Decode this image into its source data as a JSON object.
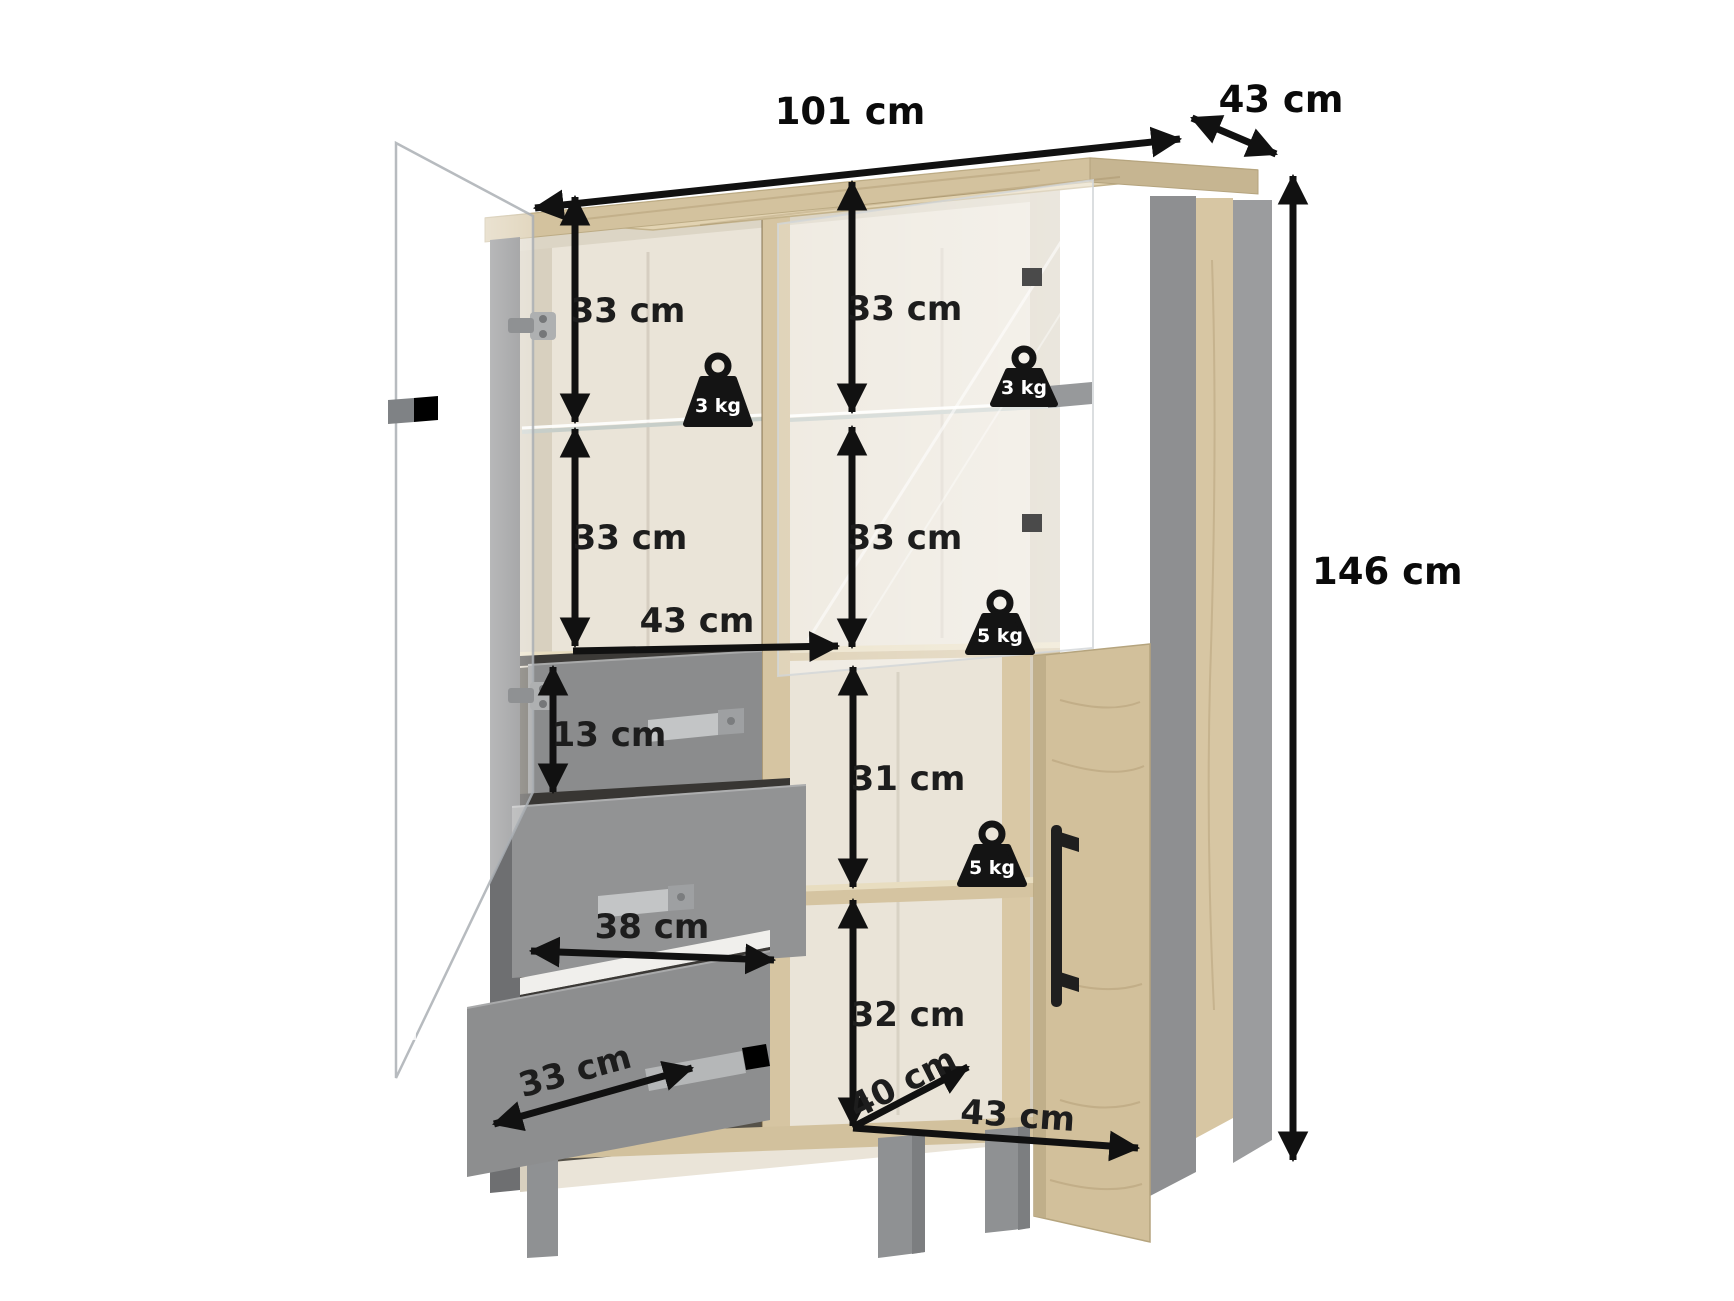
{
  "diagram": {
    "type": "furniture-dimension-diagram",
    "product": "display-cabinet",
    "background_color": "#ffffff",
    "annotation_color": "#111111",
    "overall": {
      "width": "101 cm",
      "depth": "43 cm",
      "height": "146 cm"
    },
    "internal": {
      "upper_left_height": "33 cm",
      "upper_right_height": "33 cm",
      "middle_left_height": "33 cm",
      "middle_right_height": "33 cm",
      "left_inner_width": "43 cm",
      "top_drawer_height": "13 cm",
      "drawer_width": "38 cm",
      "bottom_drawer_depth": "33 cm",
      "lower_right_upper_height": "31 cm",
      "lower_right_lower_height": "32 cm",
      "inner_depth": "40 cm",
      "lower_right_width": "43 cm"
    },
    "capacities": {
      "left_glass_shelf": "3 kg",
      "right_glass_shelf": "3 kg",
      "middle_shelf": "5 kg",
      "lower_right_shelf": "5 kg"
    },
    "materials": {
      "oak": "#d6c5a1",
      "oak_top": "#e2d3b2",
      "interior": "#eae4d8",
      "drawer_gray": "#8e8f90",
      "frame_gray": "#919294",
      "handle_black": "#1f1f1f",
      "glass_tint": "rgba(255,255,255,0.55)"
    }
  }
}
